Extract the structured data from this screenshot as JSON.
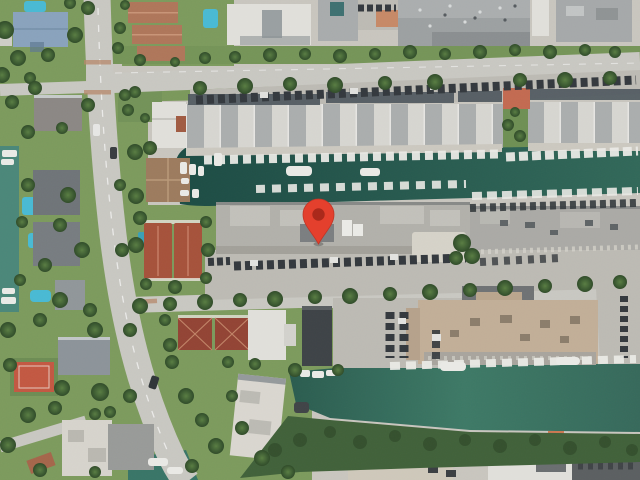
{
  "map": {
    "view": "satellite",
    "marker": {
      "icon": "map-pin",
      "x": 318,
      "y": 215,
      "fill": "#e0402e",
      "core": "#a6291b",
      "outline": "#bd3526"
    },
    "palette": {
      "ground": "#c9c6c0",
      "vegetation": "#7d9a5f",
      "vegetation_dark": "#65854c",
      "tree_light": "#597c44",
      "tree_dark": "#2f4a29",
      "water_canal_dark": "#1d4a43",
      "water_canal_light": "#326758",
      "water_canal2_a": "#2b5b4e",
      "water_canal2_b": "#3f7866",
      "water_marina": "#4c8679",
      "pool": "#4cb9d2",
      "road": "#c9c8c3",
      "road_minor": "#c5c4bf",
      "parking": "#bdbbb4",
      "parking_dark": "#5a5e60",
      "roof_white": "#e2e1dc",
      "roof_gray": "#a2a5a6",
      "roof_dark_band": "#4d555c",
      "roof_blue": "#8aa3bc",
      "roof_red": "#a3523c",
      "roof_red_dark": "#8f4435",
      "roof_tan": "#c2af99",
      "court_red": "#bf5843",
      "car_dark": "#33383c",
      "boat_white": "#ebebe7",
      "mangrove": "#41603a",
      "sand": "#cfc9bc"
    }
  }
}
